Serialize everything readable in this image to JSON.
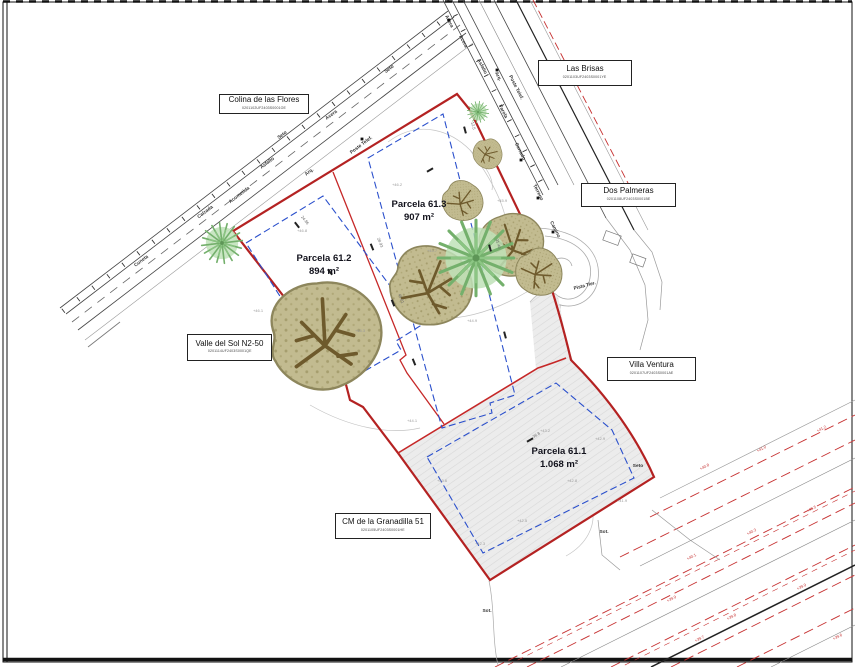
{
  "colors": {
    "boundary_red": "#b42222",
    "divider_red": "#c62828",
    "envelope_blue": "#2b50cc",
    "corridor_red": "#c63030",
    "parcel_fill": "#ececec",
    "tree_olive": "#c2bb90",
    "tree_palm": "#bfe2b8",
    "annotation_gray": "#3a3a3a"
  },
  "parcels": [
    {
      "name": "Parcela 61.2",
      "area": "894 m²"
    },
    {
      "name": "Parcela 61.3",
      "area": "907 m²"
    },
    {
      "name": "Parcela 61.1",
      "area": "1.068 m²"
    }
  ],
  "streets": [
    {
      "name": "Colina de las Flores",
      "code": "0201102UF2403S0001OE"
    },
    {
      "name": "Las Brisas",
      "code": "0201103UF2403S0001YE"
    },
    {
      "name": "Dos Palmeras",
      "code": "0201108UF2403S0001BE"
    },
    {
      "name": "Valle del Sol N2-50",
      "code": "0201114UF2403S0001QE"
    },
    {
      "name": "Villa Ventura",
      "code": "0201107UF2403S0001AE"
    },
    {
      "name": "CM de la Granadilla 51",
      "code": "0201105UF2403S0001HE"
    }
  ],
  "annotations": {
    "road_labels": [
      {
        "t": "Cuneta",
        "x": 142,
        "y": 262,
        "r": -37
      },
      {
        "t": "Calzada",
        "x": 206,
        "y": 213,
        "r": -37
      },
      {
        "t": "Asfalto",
        "x": 268,
        "y": 164,
        "r": -37
      },
      {
        "t": "Acera",
        "x": 332,
        "y": 116,
        "r": -37
      },
      {
        "t": "Seto",
        "x": 390,
        "y": 70,
        "r": -37
      },
      {
        "t": "Seto",
        "x": 283,
        "y": 136,
        "r": -37
      },
      {
        "t": "Poste Telef.",
        "x": 362,
        "y": 146,
        "r": -37
      },
      {
        "t": "Arq.",
        "x": 310,
        "y": 173,
        "r": -37
      },
      {
        "t": "Acometida",
        "x": 240,
        "y": 196,
        "r": -37
      },
      {
        "t": "Acera",
        "x": 448,
        "y": 22,
        "r": 63
      },
      {
        "t": "Acera",
        "x": 462,
        "y": 42,
        "r": 63
      },
      {
        "t": "Asfalto",
        "x": 481,
        "y": 67,
        "r": 63
      },
      {
        "t": "Arq.",
        "x": 497,
        "y": 77,
        "r": 63
      },
      {
        "t": "Poste Telef.",
        "x": 515,
        "y": 88,
        "r": 63
      },
      {
        "t": "Farola",
        "x": 502,
        "y": 112,
        "r": 63
      },
      {
        "t": "Cerrado",
        "x": 519,
        "y": 152,
        "r": 63
      },
      {
        "t": "Terreno",
        "x": 537,
        "y": 193,
        "r": 63
      },
      {
        "t": "Camino",
        "x": 554,
        "y": 230,
        "r": 63
      },
      {
        "t": "Pista Tier.",
        "x": 585,
        "y": 287,
        "r": -15
      },
      {
        "t": "Seto",
        "x": 638,
        "y": 467,
        "r": 0
      },
      {
        "t": "Sot.",
        "x": 487,
        "y": 612,
        "r": 0
      },
      {
        "t": "Sot.",
        "x": 604,
        "y": 533,
        "r": 0
      }
    ],
    "elev_gray": [
      {
        "t": "+46.1",
        "x": 258,
        "y": 312
      },
      {
        "t": "+46.8",
        "x": 302,
        "y": 232
      },
      {
        "t": "+45.3",
        "x": 360,
        "y": 332
      },
      {
        "t": "+46.2",
        "x": 397,
        "y": 186
      },
      {
        "t": "+45.7",
        "x": 432,
        "y": 252
      },
      {
        "t": "+44.9",
        "x": 472,
        "y": 322
      },
      {
        "t": "+45.9",
        "x": 502,
        "y": 202
      },
      {
        "t": "+43.2",
        "x": 545,
        "y": 432
      },
      {
        "t": "+42.8",
        "x": 572,
        "y": 482
      },
      {
        "t": "+42.5",
        "x": 522,
        "y": 522
      },
      {
        "t": "+41.9",
        "x": 622,
        "y": 502
      },
      {
        "t": "+43.6",
        "x": 442,
        "y": 482
      },
      {
        "t": "+44.1",
        "x": 412,
        "y": 422
      },
      {
        "t": "+42.3",
        "x": 480,
        "y": 545
      },
      {
        "t": "+42.9",
        "x": 600,
        "y": 440
      }
    ],
    "elev_red": [
      {
        "t": "+40.8",
        "x": 705,
        "y": 468
      },
      {
        "t": "+41.0",
        "x": 762,
        "y": 450
      },
      {
        "t": "+41.2",
        "x": 822,
        "y": 430
      },
      {
        "t": "+40.1",
        "x": 692,
        "y": 558
      },
      {
        "t": "+40.3",
        "x": 752,
        "y": 533
      },
      {
        "t": "+40.5",
        "x": 812,
        "y": 510
      },
      {
        "t": "+39.8",
        "x": 732,
        "y": 618
      },
      {
        "t": "+39.9",
        "x": 802,
        "y": 588
      },
      {
        "t": "+39.6",
        "x": 838,
        "y": 638
      },
      {
        "t": "+39.9",
        "x": 672,
        "y": 600
      },
      {
        "t": "+39.7",
        "x": 700,
        "y": 640
      }
    ],
    "dims": [
      {
        "x": 372,
        "y": 247,
        "r": 68,
        "n": "28.93"
      },
      {
        "x": 393,
        "y": 303,
        "r": 68,
        "n": "45.01"
      },
      {
        "x": 414,
        "y": 362,
        "r": 68,
        "n": ""
      },
      {
        "x": 465,
        "y": 130,
        "r": 75,
        "n": "12.5"
      },
      {
        "x": 490,
        "y": 248,
        "r": 75,
        "n": "31.40"
      },
      {
        "x": 505,
        "y": 335,
        "r": 75,
        "n": ""
      },
      {
        "x": 297,
        "y": 225,
        "r": 52,
        "n": "24.86"
      },
      {
        "x": 330,
        "y": 272,
        "r": 52,
        "n": ""
      },
      {
        "x": 430,
        "y": 170,
        "r": -30,
        "n": ""
      },
      {
        "x": 530,
        "y": 440,
        "r": -30,
        "n": "36.8"
      }
    ],
    "poles": [
      [
        362,
        139
      ],
      [
        449,
        20
      ],
      [
        497,
        70
      ],
      [
        521,
        160
      ],
      [
        538,
        198
      ],
      [
        553,
        232
      ]
    ]
  }
}
